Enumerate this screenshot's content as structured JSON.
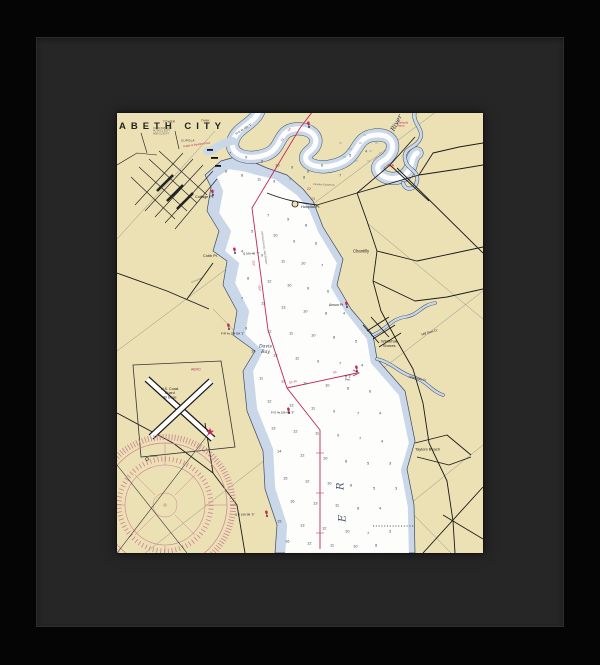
{
  "frame": {
    "frame_color": "#050505",
    "mat_color": "#262626",
    "paper_color": "#ece1b5",
    "water_shallow_color": "#c9d7e9",
    "water_deep_color": "#fdfdfb",
    "magenta_color": "#c2275a",
    "rose_color": "#cc7f92"
  },
  "chart": {
    "title": "ABETH CITY",
    "labels": [
      {
        "t": "TOWER",
        "x": 46,
        "y": 7,
        "fs": 3,
        "cls": "sm",
        "name": "label-tower"
      },
      {
        "t": "TANK",
        "x": 84,
        "y": 6,
        "fs": 3,
        "cls": "sm",
        "name": "label-tank"
      },
      {
        "t": "CUPOLA",
        "x": 64,
        "y": 26,
        "fs": 3,
        "cls": "sm",
        "name": "label-cupola"
      },
      {
        "t": "OVHD PWR CAB\nAUTH CL 50 FT\nHOR CL 80 FT",
        "x": 36,
        "y": 14,
        "fs": 2.4,
        "cls": "note",
        "name": "label-bridge-note"
      },
      {
        "t": "Cable & Pipeline Area",
        "x": 66,
        "y": 32,
        "fs": 2.8,
        "cls": "red-sm",
        "rot": -8,
        "name": "label-cable-area"
      },
      {
        "t": "Surfaced\nRamp",
        "x": 280,
        "y": 8,
        "fs": 2.8,
        "cls": "red-sm",
        "name": "label-surfaced-ramp"
      },
      {
        "t": "River",
        "x": 272,
        "y": 16,
        "fs": 6.5,
        "cls": "water-i",
        "rot": -62,
        "name": "label-river"
      },
      {
        "t": "18A",
        "x": 270,
        "y": 50,
        "fs": 4,
        "cls": "red",
        "name": "label-route-18a"
      },
      {
        "t": "22",
        "x": 190,
        "y": 74,
        "fs": 3.5,
        "cls": "red",
        "name": "label-route-22"
      },
      {
        "t": "23",
        "x": 194,
        "y": 84,
        "fs": 3.5,
        "cls": "red",
        "name": "label-route-23"
      },
      {
        "t": "Camden Causeway",
        "x": 196,
        "y": 70,
        "fs": 2.5,
        "cls": "note",
        "rot": 2,
        "name": "label-camden-causeway"
      },
      {
        "t": "Cottage Pt.",
        "x": 78,
        "y": 82,
        "fs": 3.8,
        "cls": "pt",
        "name": "label-cottage-pt"
      },
      {
        "t": "Hospital Pt.",
        "x": 184,
        "y": 92,
        "fs": 3.8,
        "cls": "pt",
        "name": "label-hospital-pt"
      },
      {
        "t": "Cobb Pt.",
        "x": 86,
        "y": 141,
        "fs": 3.8,
        "cls": "pt",
        "name": "label-cobb-pt"
      },
      {
        "t": "Chantilly",
        "x": 236,
        "y": 136,
        "fs": 4.2,
        "cls": "pt",
        "name": "label-chantilly"
      },
      {
        "t": "Anson Pt",
        "x": 212,
        "y": 190,
        "fs": 3.5,
        "cls": "pt",
        "name": "label-anson-pt"
      },
      {
        "t": "Davis\nBay",
        "x": 142,
        "y": 231,
        "fs": 4.6,
        "cls": "water-i",
        "name": "label-davis-bay"
      },
      {
        "t": "U.S. Coast\nGuard\nAir Base",
        "x": 44,
        "y": 274,
        "fs": 3.6,
        "cls": "pt-c",
        "name": "label-coast-guard-air-base"
      },
      {
        "t": "AERO",
        "x": 74,
        "y": 255,
        "fs": 3.4,
        "cls": "red",
        "name": "label-aero"
      },
      {
        "t": "Whitehall\nShores",
        "x": 264,
        "y": 226,
        "fs": 4,
        "cls": "pt-c",
        "name": "label-whitehall-shores"
      },
      {
        "t": "Mill Dam Cr",
        "x": 304,
        "y": 220,
        "fs": 3.2,
        "cls": "pt",
        "rot": -16,
        "name": "label-mill-dam-cr"
      },
      {
        "t": "Areneuse Cr",
        "x": 292,
        "y": 262,
        "fs": 3.2,
        "cls": "pt",
        "rot": 12,
        "name": "label-areneuse-cr"
      },
      {
        "t": "Taylors Beach",
        "x": 298,
        "y": 334,
        "fs": 4,
        "cls": "pt",
        "name": "label-taylors-beach"
      },
      {
        "t": "R",
        "x": 218,
        "y": 377,
        "fs": 10,
        "cls": "river-letter",
        "rot": -90,
        "name": "label-river-letter-r"
      },
      {
        "t": "E",
        "x": 220,
        "y": 409,
        "fs": 10,
        "cls": "river-letter",
        "rot": -90,
        "name": "label-river-letter-e"
      },
      {
        "t": "TANK",
        "x": 33,
        "y": 342,
        "fs": 2.6,
        "cls": "sm",
        "name": "label-rose-tank"
      },
      {
        "t": "INTRACOASTAL WATERWAY",
        "x": 146,
        "y": 118,
        "fs": 2.5,
        "cls": "note",
        "rot": 82,
        "name": "label-intracoastal-waterway"
      },
      {
        "t": "2.4 mi HW",
        "x": 74,
        "y": 168,
        "fs": 2.5,
        "cls": "note",
        "rot": -20,
        "name": "label-hw-note"
      },
      {
        "t": "Fl G 4s 16ft “1”",
        "x": 118,
        "y": 20,
        "fs": 2.8,
        "cls": "lt",
        "rot": -33,
        "name": "label-light-1"
      },
      {
        "t": "Q 16ft 4M “7”",
        "x": 126,
        "y": 139,
        "fs": 2.8,
        "cls": "lt",
        "name": "label-light-7"
      },
      {
        "t": "Fl R 4s 15ft 5M “2”",
        "x": 104,
        "y": 219,
        "fs": 2.8,
        "cls": "lt",
        "name": "label-light-2"
      },
      {
        "t": "Fl G 4s 15ft 4M “5”",
        "x": 154,
        "y": 298,
        "fs": 2.8,
        "cls": "lt",
        "name": "label-light-5"
      },
      {
        "t": "R “2”\nPriv",
        "x": 228,
        "y": 262,
        "fs": 2.8,
        "cls": "lt",
        "name": "label-light-2-priv"
      },
      {
        "t": "Q G 16ft 3M “9”",
        "x": 118,
        "y": 400,
        "fs": 2.8,
        "cls": "lt",
        "name": "label-light-9"
      },
      {
        "t": "54",
        "x": 170,
        "y": 17,
        "fs": 3,
        "cls": "mag",
        "rot": -55,
        "name": "label-course-54-top"
      },
      {
        "t": "51",
        "x": 163,
        "y": 27,
        "fs": 3,
        "cls": "mag",
        "rot": -55,
        "name": "label-course-51-top"
      },
      {
        "t": "231°",
        "x": 138,
        "y": 147,
        "fs": 3,
        "cls": "mag",
        "rot": 83,
        "name": "label-course-231"
      },
      {
        "t": "051°",
        "x": 144,
        "y": 172,
        "fs": 3,
        "cls": "mag",
        "rot": 83,
        "name": "label-course-051"
      },
      {
        "t": "51 44",
        "x": 172,
        "y": 268,
        "fs": 3,
        "cls": "mag",
        "rot": -12,
        "name": "label-course-51-44"
      },
      {
        "t": "54",
        "x": 216,
        "y": 258,
        "fs": 3,
        "cls": "mag",
        "rot": -12,
        "name": "label-course-54-mid"
      }
    ],
    "soundings": [
      [
        112,
        38,
        7
      ],
      [
        128,
        42,
        9
      ],
      [
        144,
        46,
        8
      ],
      [
        158,
        50,
        10
      ],
      [
        174,
        52,
        9
      ],
      [
        190,
        56,
        8
      ],
      [
        204,
        50,
        6
      ],
      [
        108,
        56,
        6
      ],
      [
        124,
        60,
        8
      ],
      [
        140,
        64,
        11
      ],
      [
        156,
        66,
        9
      ],
      [
        172,
        64,
        7
      ],
      [
        186,
        62,
        8
      ],
      [
        232,
        40,
        5
      ],
      [
        248,
        36,
        4
      ],
      [
        222,
        60,
        7
      ],
      [
        150,
        100,
        7
      ],
      [
        170,
        104,
        9
      ],
      [
        188,
        110,
        8
      ],
      [
        134,
        116,
        5
      ],
      [
        156,
        120,
        10
      ],
      [
        176,
        126,
        9
      ],
      [
        198,
        128,
        6
      ],
      [
        124,
        136,
        4
      ],
      [
        144,
        140,
        9
      ],
      [
        164,
        146,
        11
      ],
      [
        184,
        148,
        10
      ],
      [
        204,
        150,
        7
      ],
      [
        130,
        163,
        8
      ],
      [
        150,
        166,
        12
      ],
      [
        170,
        170,
        10
      ],
      [
        190,
        173,
        9
      ],
      [
        210,
        176,
        6
      ],
      [
        124,
        183,
        7
      ],
      [
        144,
        188,
        11
      ],
      [
        164,
        192,
        13
      ],
      [
        186,
        196,
        10
      ],
      [
        208,
        198,
        8
      ],
      [
        226,
        198,
        4
      ],
      [
        128,
        213,
        9
      ],
      [
        150,
        216,
        12
      ],
      [
        172,
        218,
        11
      ],
      [
        194,
        220,
        10
      ],
      [
        216,
        222,
        8
      ],
      [
        238,
        226,
        5
      ],
      [
        134,
        236,
        10
      ],
      [
        156,
        240,
        13
      ],
      [
        178,
        243,
        11
      ],
      [
        200,
        246,
        9
      ],
      [
        222,
        248,
        7
      ],
      [
        244,
        250,
        4
      ],
      [
        142,
        263,
        11
      ],
      [
        164,
        266,
        12
      ],
      [
        186,
        268,
        11
      ],
      [
        208,
        270,
        10
      ],
      [
        230,
        273,
        8
      ],
      [
        252,
        276,
        6
      ],
      [
        150,
        286,
        12
      ],
      [
        172,
        290,
        13
      ],
      [
        194,
        293,
        11
      ],
      [
        216,
        296,
        9
      ],
      [
        240,
        298,
        7
      ],
      [
        262,
        298,
        4
      ],
      [
        154,
        313,
        13
      ],
      [
        176,
        316,
        12
      ],
      [
        198,
        318,
        11
      ],
      [
        220,
        320,
        9
      ],
      [
        242,
        323,
        7
      ],
      [
        264,
        326,
        4
      ],
      [
        160,
        336,
        14
      ],
      [
        183,
        340,
        12
      ],
      [
        206,
        343,
        10
      ],
      [
        228,
        346,
        8
      ],
      [
        250,
        348,
        5
      ],
      [
        272,
        348,
        3
      ],
      [
        166,
        363,
        15
      ],
      [
        188,
        366,
        12
      ],
      [
        210,
        368,
        10
      ],
      [
        233,
        370,
        8
      ],
      [
        256,
        373,
        5
      ],
      [
        278,
        373,
        3
      ],
      [
        173,
        386,
        16
      ],
      [
        196,
        388,
        13
      ],
      [
        218,
        390,
        11
      ],
      [
        240,
        393,
        8
      ],
      [
        262,
        393,
        4
      ],
      [
        160,
        406,
        15
      ],
      [
        183,
        410,
        13
      ],
      [
        205,
        413,
        12
      ],
      [
        228,
        416,
        10
      ],
      [
        250,
        418,
        7
      ],
      [
        272,
        416,
        3
      ],
      [
        168,
        426,
        16
      ],
      [
        190,
        428,
        12
      ],
      [
        213,
        430,
        11
      ],
      [
        236,
        431,
        10
      ],
      [
        258,
        430,
        8
      ]
    ]
  }
}
